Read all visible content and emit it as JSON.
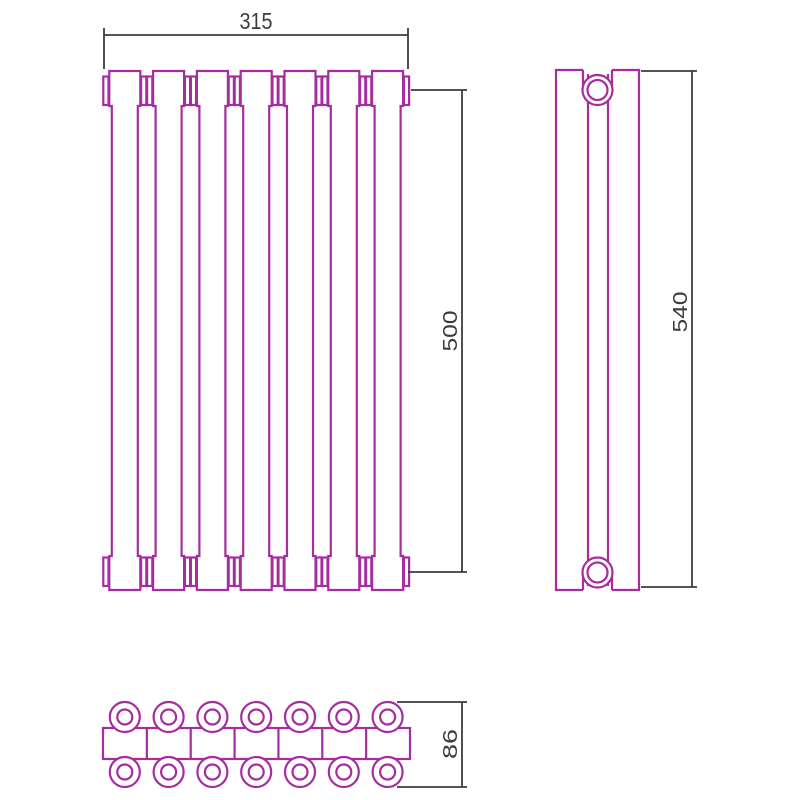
{
  "title": "radiator-dimension-drawing",
  "colors": {
    "outline": "#A62D9F",
    "dimension": "#3C3C3C",
    "background": "#FFFFFF"
  },
  "views": {
    "front": {
      "label": "front view",
      "sections": 7,
      "width_label": "315",
      "height_label": "500"
    },
    "side": {
      "label": "side view",
      "height_label": "540"
    },
    "top": {
      "label": "top view",
      "sections": 7,
      "depth_label": "86"
    }
  },
  "dimension_labels": {
    "width": "315",
    "height": "500",
    "side_height": "540",
    "depth": "86"
  }
}
